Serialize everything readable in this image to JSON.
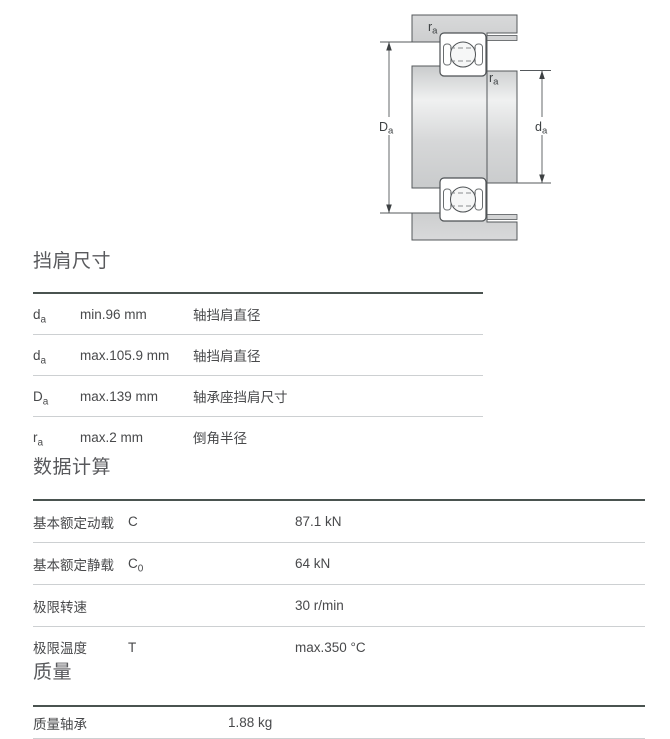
{
  "diagram": {
    "label_Da": {
      "sym": "D",
      "sub": "a"
    },
    "label_da": {
      "sym": "d",
      "sub": "a"
    },
    "label_ra_top": {
      "sym": "r",
      "sub": "a"
    },
    "label_ra_bottom": {
      "sym": "r",
      "sub": "a"
    }
  },
  "sections": {
    "shoulder": {
      "title": "挡肩尺寸",
      "rows": [
        {
          "sym": "d",
          "sub": "a",
          "value": "min.96 mm",
          "desc": "轴挡肩直径"
        },
        {
          "sym": "d",
          "sub": "a",
          "value": "max.105.9 mm",
          "desc": "轴挡肩直径"
        },
        {
          "sym": "D",
          "sub": "a",
          "value": "max.139 mm",
          "desc": "轴承座挡肩尺寸"
        },
        {
          "sym": "r",
          "sub": "a",
          "value": "max.2 mm",
          "desc": "倒角半径"
        }
      ]
    },
    "calc": {
      "title": "数据计算",
      "rows": [
        {
          "label": "基本额定动载",
          "sym": "C",
          "sub": "",
          "value": "87.1 kN"
        },
        {
          "label": "基本额定静载",
          "sym": "C",
          "sub": "0",
          "value": "64 kN"
        },
        {
          "label": "极限转速",
          "sym": "",
          "sub": "",
          "value": "30 r/min"
        },
        {
          "label": "极限温度",
          "sym": "T",
          "sub": "",
          "value": "max.350 °C"
        }
      ]
    },
    "mass": {
      "title": "质量",
      "rows": [
        {
          "label": "质量轴承",
          "value": "1.88 kg"
        }
      ]
    }
  },
  "colors": {
    "table_top_border": "#4a5350",
    "row_divider": "#cdd0d2",
    "body_text": "#48494b",
    "heading_text": "#58595c",
    "diagram_fill": "#d3d4d5",
    "diagram_stroke": "#54585b"
  }
}
